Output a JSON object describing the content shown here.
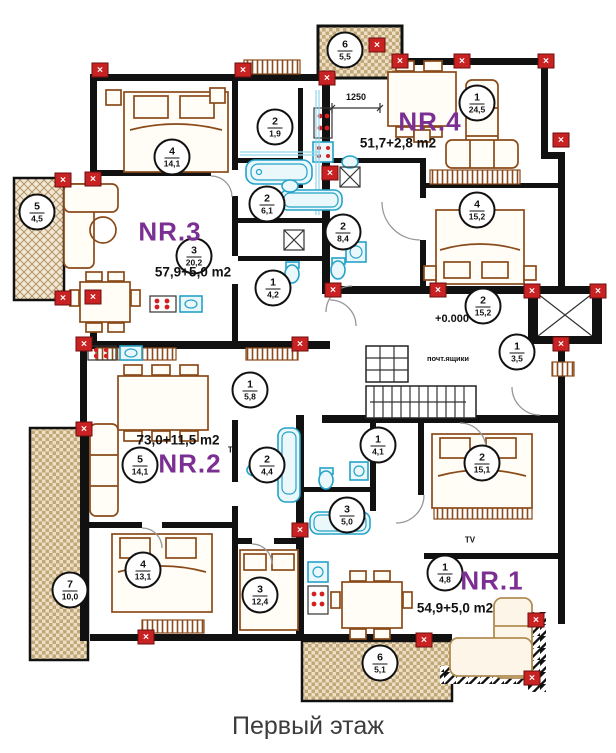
{
  "page": {
    "caption": "Первый этаж"
  },
  "apartments": [
    {
      "label": "NR.3",
      "area": "57,9+5,0 m2"
    },
    {
      "label": "NR.4",
      "area": "51,7+2,8 m2"
    },
    {
      "label": "NR.2",
      "area": "73,0+11,5 m2"
    },
    {
      "label": "NR.1",
      "area": "54,9+5,0 m2"
    }
  ],
  "annotations": {
    "level_mark": "+0.000",
    "dimension": "1250",
    "mailboxes": "почт.ящики",
    "tv": "TV"
  },
  "room_markers": [
    {
      "num": "4",
      "area": "14,1"
    },
    {
      "num": "3",
      "area": "20,2"
    },
    {
      "num": "2",
      "area": "6,1"
    },
    {
      "num": "1",
      "area": "4,2"
    },
    {
      "num": "5",
      "area": "4,5"
    },
    {
      "num": "6",
      "area": "5,5"
    },
    {
      "num": "1",
      "area": "24,5"
    },
    {
      "num": "4",
      "area": "15,2"
    },
    {
      "num": "2",
      "area": "8,4"
    },
    {
      "num": "2",
      "area": "1,9"
    },
    {
      "num": "2",
      "area": "15,2"
    },
    {
      "num": "1",
      "area": "3,5"
    },
    {
      "num": "5",
      "area": "14,1"
    },
    {
      "num": "2",
      "area": "4,4"
    },
    {
      "num": "1",
      "area": "5,8"
    },
    {
      "num": "4",
      "area": "13,1"
    },
    {
      "num": "3",
      "area": "12,4"
    },
    {
      "num": "7",
      "area": "10,0"
    },
    {
      "num": "1",
      "area": "4,1"
    },
    {
      "num": "3",
      "area": "5,0"
    },
    {
      "num": "2",
      "area": "15,1"
    },
    {
      "num": "1",
      "area": "4,8"
    },
    {
      "num": "6",
      "area": "5,1"
    }
  ],
  "icons": {
    "wall_marker_glyph": "✕"
  },
  "colors": {
    "apartment_label": "#7b2f92",
    "wall": "#111111",
    "wall_marker": "#c92222",
    "fixture_blue": "#24a3c9",
    "furniture_brown": "#8a4a1a",
    "balcony_tan": "#c2a878"
  }
}
